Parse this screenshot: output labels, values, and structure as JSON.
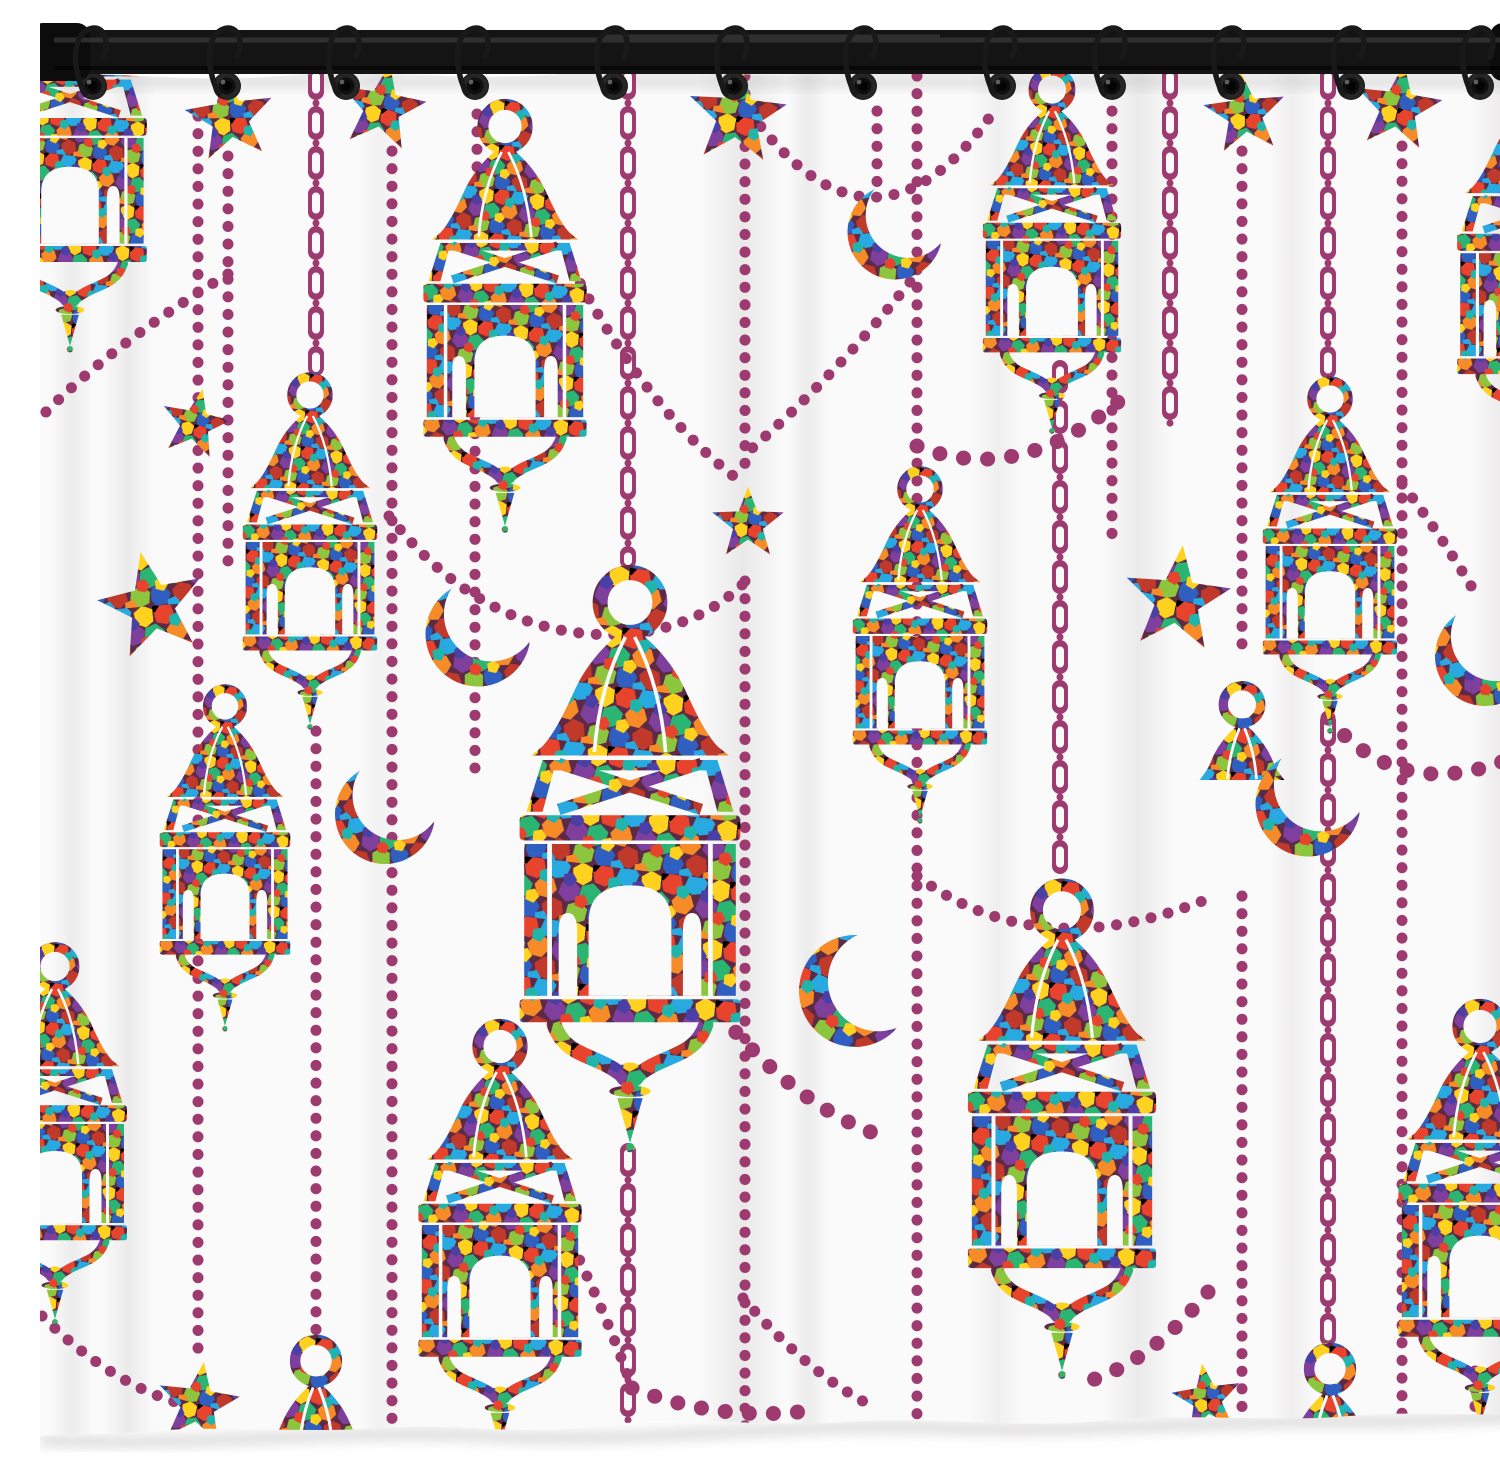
{
  "meta": {
    "alt": "Colorful mosaic Ramadan lantern shower curtain product photo: stained-glass style hanging lanterns, crescent moons and stars joined by plum bead strings and chains, hung on a black rod with twelve metal hooks, white background",
    "product": "shower curtain"
  },
  "palette": {
    "bead_plum": "#9d3a70",
    "grout": "#5d2a46",
    "rod_black": "#141414",
    "curtain_white": "#fbfafa",
    "mosaic": [
      "#e8432d",
      "#f68b28",
      "#ffd21f",
      "#8cc63e",
      "#2bb573",
      "#1fb5ad",
      "#29a9e1",
      "#2f5fc0",
      "#4a3fa5",
      "#7e3f9d",
      "#c0392b"
    ]
  },
  "rod": {
    "hook_count": 12
  },
  "curtain": {
    "grommet_count": 12
  },
  "scene": {
    "grommet_y": 70,
    "grommet_xs": [
      53,
      187,
      306,
      435,
      574,
      694,
      823,
      962,
      1072,
      1191,
      1311,
      1440
    ],
    "lanterns": [
      {
        "x": 30,
        "y": -70,
        "s": 0.8
      },
      {
        "x": 465,
        "y": 85,
        "s": 0.85
      },
      {
        "x": 270,
        "y": 358,
        "s": 0.7
      },
      {
        "x": 185,
        "y": 670,
        "s": 0.68
      },
      {
        "x": 15,
        "y": 928,
        "s": 0.75
      },
      {
        "x": 590,
        "y": 552,
        "s": 1.15
      },
      {
        "x": 880,
        "y": 452,
        "s": 0.7
      },
      {
        "x": 1012,
        "y": 52,
        "s": 0.72
      },
      {
        "x": 1290,
        "y": 362,
        "s": 0.7
      },
      {
        "x": 1022,
        "y": 865,
        "s": 0.98
      },
      {
        "x": 1492,
        "y": 50,
        "s": 0.78
      },
      {
        "x": 1440,
        "y": 985,
        "s": 0.85
      },
      {
        "x": 460,
        "y": 1005,
        "s": 0.85
      }
    ],
    "teardrops": [
      {
        "x": 276,
        "y": 1322,
        "s": 0.95
      },
      {
        "x": 1290,
        "y": 1330,
        "s": 0.95
      },
      {
        "x": 1202,
        "y": 668,
        "s": 0.85
      }
    ],
    "stars": [
      {
        "x": 190,
        "y": 102,
        "s": 0.92,
        "r": -8
      },
      {
        "x": 342,
        "y": 92,
        "s": 0.9,
        "r": 10
      },
      {
        "x": 697,
        "y": 100,
        "s": 1.02,
        "r": 5
      },
      {
        "x": 1205,
        "y": 98,
        "s": 0.85,
        "r": -6
      },
      {
        "x": 1358,
        "y": 92,
        "s": 0.9,
        "r": 8
      },
      {
        "x": 708,
        "y": 508,
        "s": 0.75,
        "r": 0
      },
      {
        "x": 112,
        "y": 590,
        "s": 1.1,
        "r": -12
      },
      {
        "x": 1137,
        "y": 584,
        "s": 1.1,
        "r": 6
      },
      {
        "x": 155,
        "y": 408,
        "s": 0.72,
        "r": 12
      },
      {
        "x": 1167,
        "y": 1383,
        "s": 0.72,
        "r": -8
      },
      {
        "x": 158,
        "y": 1388,
        "s": 0.85,
        "r": 8
      }
    ],
    "crescents": [
      {
        "x": 855,
        "y": 216,
        "s": 0.95,
        "r": -10
      },
      {
        "x": 438,
        "y": 618,
        "s": 1.05,
        "r": -15
      },
      {
        "x": 345,
        "y": 798,
        "s": 1.0,
        "r": -15
      },
      {
        "x": 1268,
        "y": 788,
        "s": 1.05,
        "r": -15
      },
      {
        "x": 815,
        "y": 975,
        "s": 1.12,
        "r": 18
      },
      {
        "x": 1445,
        "y": 640,
        "s": 1.0,
        "r": -20
      },
      {
        "x": 1504,
        "y": 293,
        "s": 0.95,
        "r": -35
      }
    ],
    "dot_lines": [
      {
        "x": 158,
        "y1": 100,
        "y2": 1335
      },
      {
        "x": 188,
        "y1": 140,
        "y2": 555
      },
      {
        "x": 276,
        "y1": 715,
        "y2": 1315
      },
      {
        "x": 352,
        "y1": 135,
        "y2": 1420
      },
      {
        "x": 437,
        "y1": 98,
        "y2": 152
      },
      {
        "x": 435,
        "y1": 400,
        "y2": 752
      },
      {
        "x": 705,
        "y1": 60,
        "y2": 452
      },
      {
        "x": 705,
        "y1": 565,
        "y2": 1420
      },
      {
        "x": 837,
        "y1": 95,
        "y2": 178
      },
      {
        "x": 877,
        "y1": 60,
        "y2": 1420
      },
      {
        "x": 1072,
        "y1": 95,
        "y2": 520
      },
      {
        "x": 1202,
        "y1": 135,
        "y2": 640
      },
      {
        "x": 1202,
        "y1": 880,
        "y2": 1420
      },
      {
        "x": 1362,
        "y1": 130,
        "y2": 1420
      },
      {
        "x": 1435,
        "y1": 1355,
        "y2": 1420
      },
      {
        "x": 1472,
        "y1": 60,
        "y2": 1420
      }
    ],
    "chain_lines": [
      {
        "x": 276,
        "y1": 58,
        "y2": 352
      },
      {
        "x": 588,
        "y1": 58,
        "y2": 545
      },
      {
        "x": 588,
        "y1": 1135,
        "y2": 1420
      },
      {
        "x": 1020,
        "y1": 352,
        "y2": 858
      },
      {
        "x": 1130,
        "y1": 58,
        "y2": 410
      },
      {
        "x": 1288,
        "y1": 58,
        "y2": 355
      },
      {
        "x": 1288,
        "y1": 705,
        "y2": 1322
      }
    ],
    "swags": [
      {
        "d": "M700,82 Q828,272 952,98",
        "heavy": false
      },
      {
        "d": "M188,258 Q70,330 2,400",
        "heavy": false
      },
      {
        "d": "M532,252 Q610,400 704,468",
        "heavy": false
      },
      {
        "d": "M349,500 Q450,628 590,618 Q660,610 703,568",
        "heavy": false
      },
      {
        "d": "M870,266 Q795,360 710,434",
        "heavy": false
      },
      {
        "d": "M877,430 Q980,472 1085,380",
        "heavy": true
      },
      {
        "d": "M1362,468 Q1402,520 1440,585",
        "heavy": false
      },
      {
        "d": "M1288,702 Q1360,788 1472,742",
        "heavy": true
      },
      {
        "d": "M2,1300 Q75,1372 150,1390",
        "heavy": false
      },
      {
        "d": "M532,1228 Q572,1312 592,1372",
        "heavy": false
      },
      {
        "d": "M592,1372 Q672,1404 758,1396",
        "heavy": true
      },
      {
        "d": "M703,1282 Q770,1360 836,1392",
        "heavy": false
      },
      {
        "d": "M680,998 Q755,1088 836,1118",
        "heavy": true
      },
      {
        "d": "M1168,1276 Q1112,1344 1052,1364",
        "heavy": true
      },
      {
        "d": "M877,860 Q1000,952 1170,882",
        "heavy": false
      }
    ]
  }
}
